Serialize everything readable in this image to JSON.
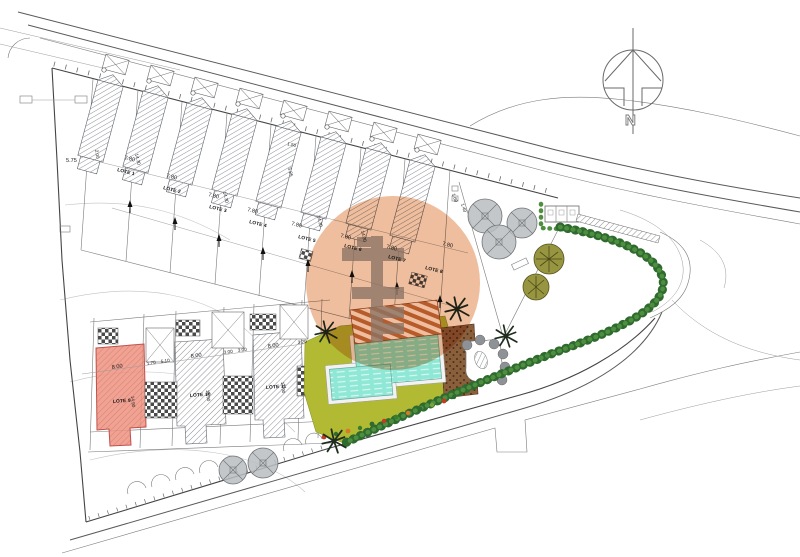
{
  "plan": {
    "north_label": "N",
    "lots_top": [
      {
        "name": "LOTE 1",
        "frontage": "7.80"
      },
      {
        "name": "LOTE 2",
        "frontage": "7.80"
      },
      {
        "name": "LOTE 3",
        "frontage": "7.80"
      },
      {
        "name": "LOTE 4",
        "frontage": "7.80"
      },
      {
        "name": "LOTE 5",
        "frontage": "7.80"
      },
      {
        "name": "LOTE 6",
        "frontage": "7.80"
      },
      {
        "name": "LOTE 7",
        "frontage": "7.80"
      },
      {
        "name": "LOTE 8",
        "frontage": "7.80"
      }
    ],
    "lots_bottom": [
      {
        "name": "LOTE 9",
        "frontage": "8.00",
        "depth": "14.90"
      },
      {
        "name": "LOTE 10",
        "frontage": "8.00",
        "depth": "14.90"
      },
      {
        "name": "LOTE 11",
        "frontage": "8.00",
        "depth": "14.90"
      }
    ],
    "dims": {
      "d575": "5.75",
      "d200": "2.00",
      "d1430": "14.30",
      "d525": "5.25",
      "d150": "1.50",
      "d170": "1.70",
      "d510": "5.10",
      "d300a": "3.00",
      "d300b": "3.00",
      "d320": "3.20",
      "d160": "1.60",
      "d140": "1.40"
    },
    "colors": {
      "highlight_circle": "#E0884F",
      "highlight_lot": "#EE9280",
      "lawn": "#B2BA33",
      "pool_water": "#8FE7D6",
      "deck": "#8A5F3C",
      "hedge": "#2F6A2F"
    }
  }
}
